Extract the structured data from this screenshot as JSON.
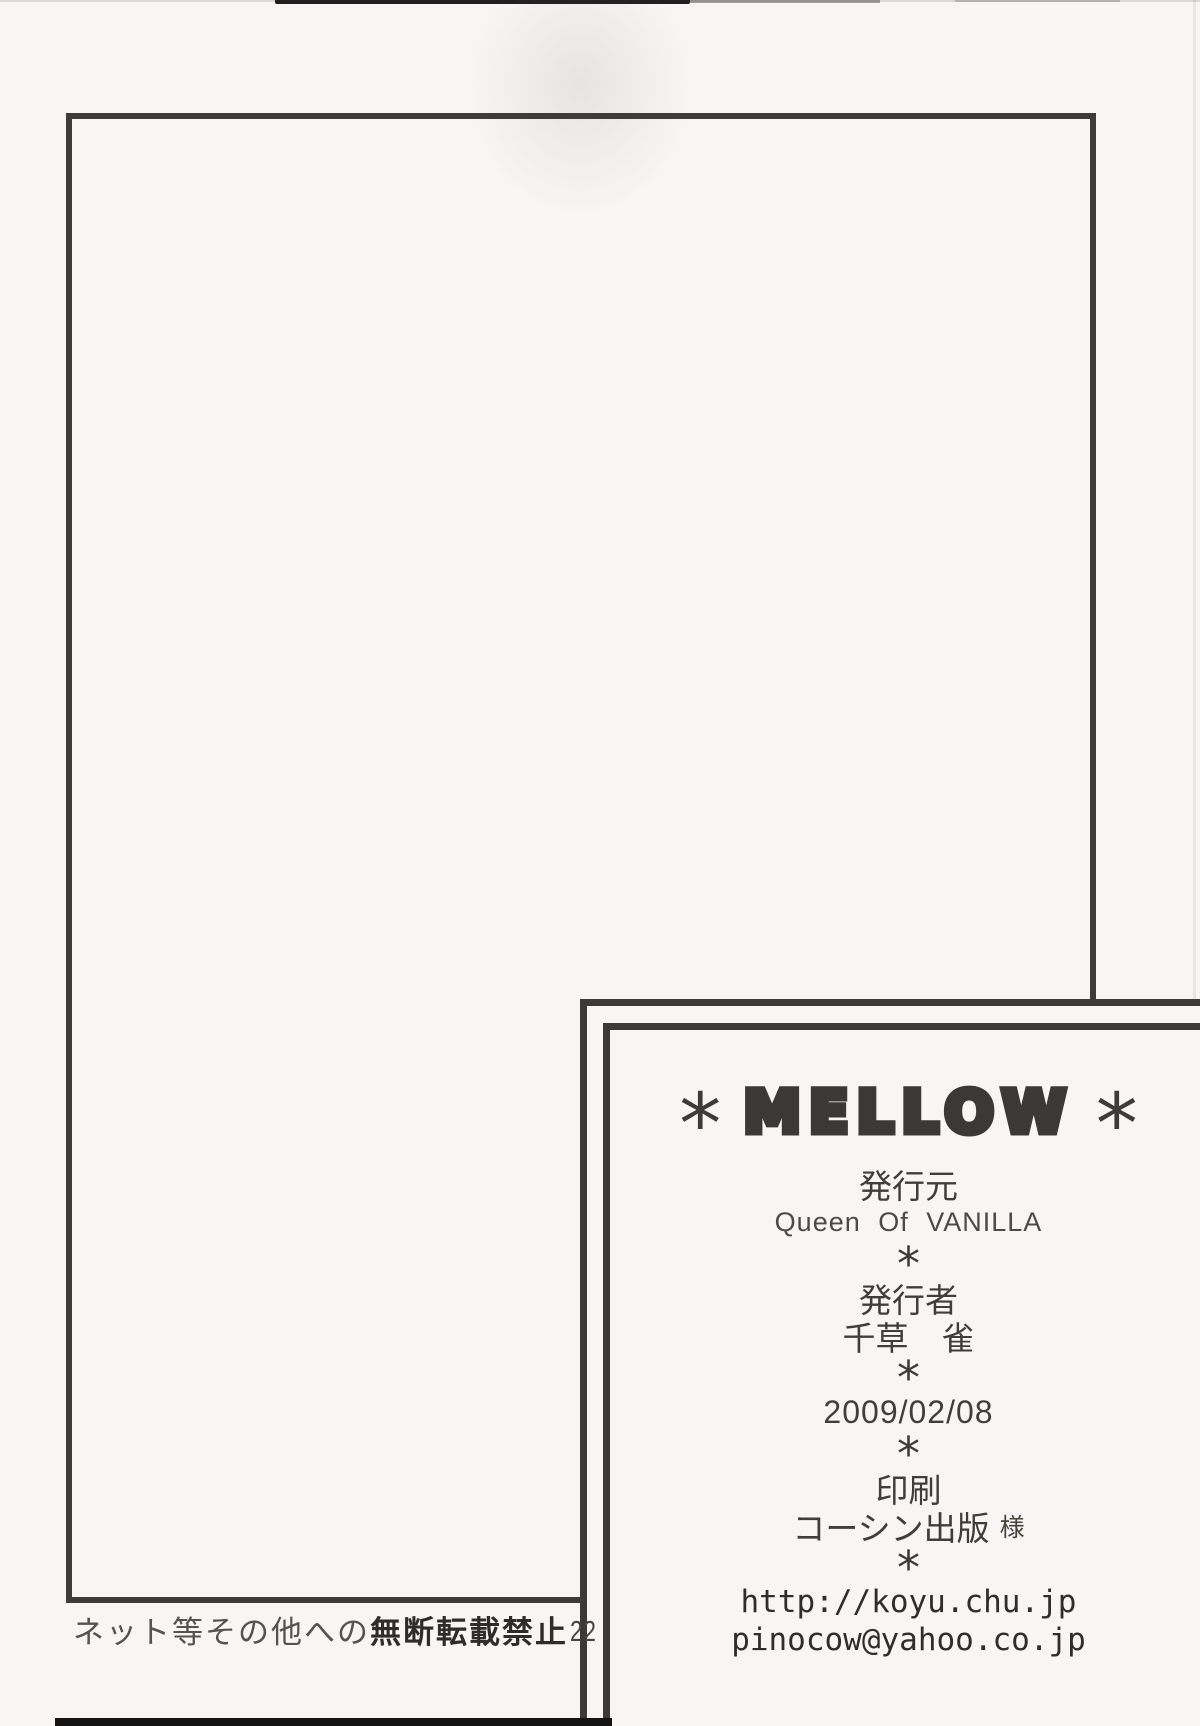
{
  "colophon": {
    "title_asterisk_left": "*",
    "title": "MELLOW",
    "title_asterisk_right": "*",
    "publisher_label": "発行元",
    "publisher_name": "Queen Of VANILLA",
    "separator": "*",
    "author_label": "発行者",
    "author_name": "千草　雀",
    "publish_date": "2009/02/08",
    "printer_label": "印刷",
    "printer_name": "コーシン出版",
    "printer_honorific": "様",
    "website_url": "http://koyu.chu.jp",
    "contact_email": "pinocow@yahoo.co.jp"
  },
  "footer": {
    "disclaimer_prefix": "ネット等その他への",
    "disclaimer_emphasis": "無断転載禁止",
    "page_number": "22"
  },
  "colors": {
    "paper": "#f7f6f4",
    "ink": "#3b3a38",
    "frame_border": "#3d3c3a",
    "scan_edge": "#141414"
  }
}
